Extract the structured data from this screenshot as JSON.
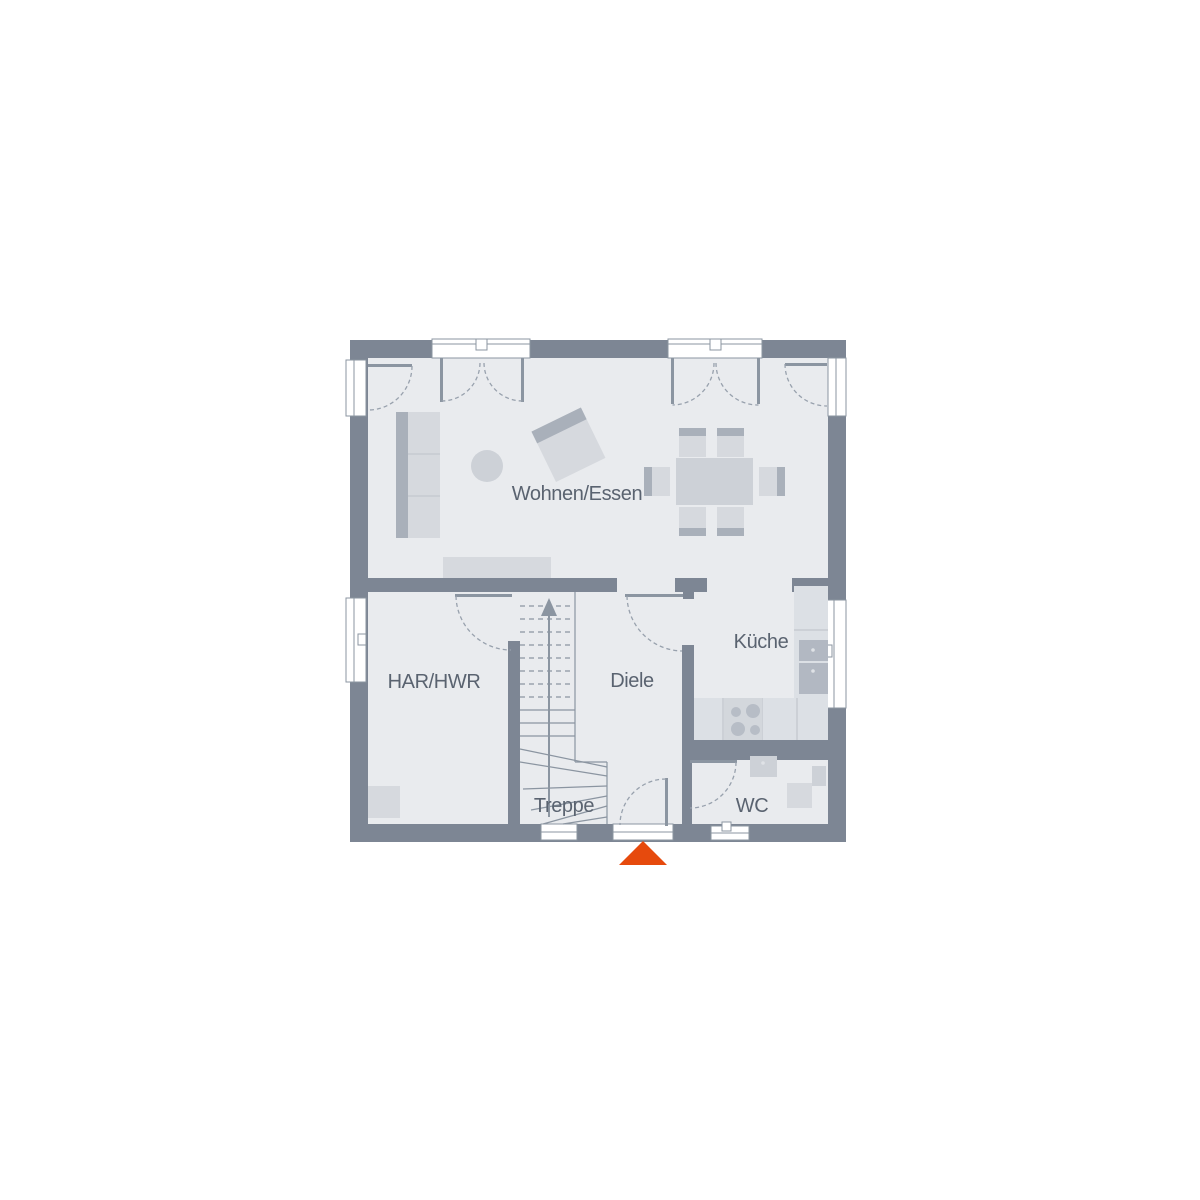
{
  "floorplan": {
    "rooms": [
      {
        "id": "wohnen-essen",
        "label": "Wohnen/Essen"
      },
      {
        "id": "har-hwr",
        "label": "HAR/HWR"
      },
      {
        "id": "diele",
        "label": "Diele"
      },
      {
        "id": "kueche",
        "label": "Küche"
      },
      {
        "id": "treppe",
        "label": "Treppe"
      },
      {
        "id": "wc",
        "label": "WC"
      }
    ],
    "colors": {
      "wall": "#7d8694",
      "floor": "#e9ebee",
      "window": "#ffffff",
      "frame_line": "#8b95a1",
      "door_arc": "#98a1ad",
      "furniture_light": "#d6d9de",
      "furniture_mid": "#cdd1d7",
      "furniture_dark": "#a9b0ba",
      "counter": "#dce0e5",
      "appliance": "#b2b8c2",
      "burner": "#b7bdc6",
      "divider": "#c6cbd1",
      "label_text": "#5a6370",
      "entrance_marker": "#e64a0d"
    }
  }
}
